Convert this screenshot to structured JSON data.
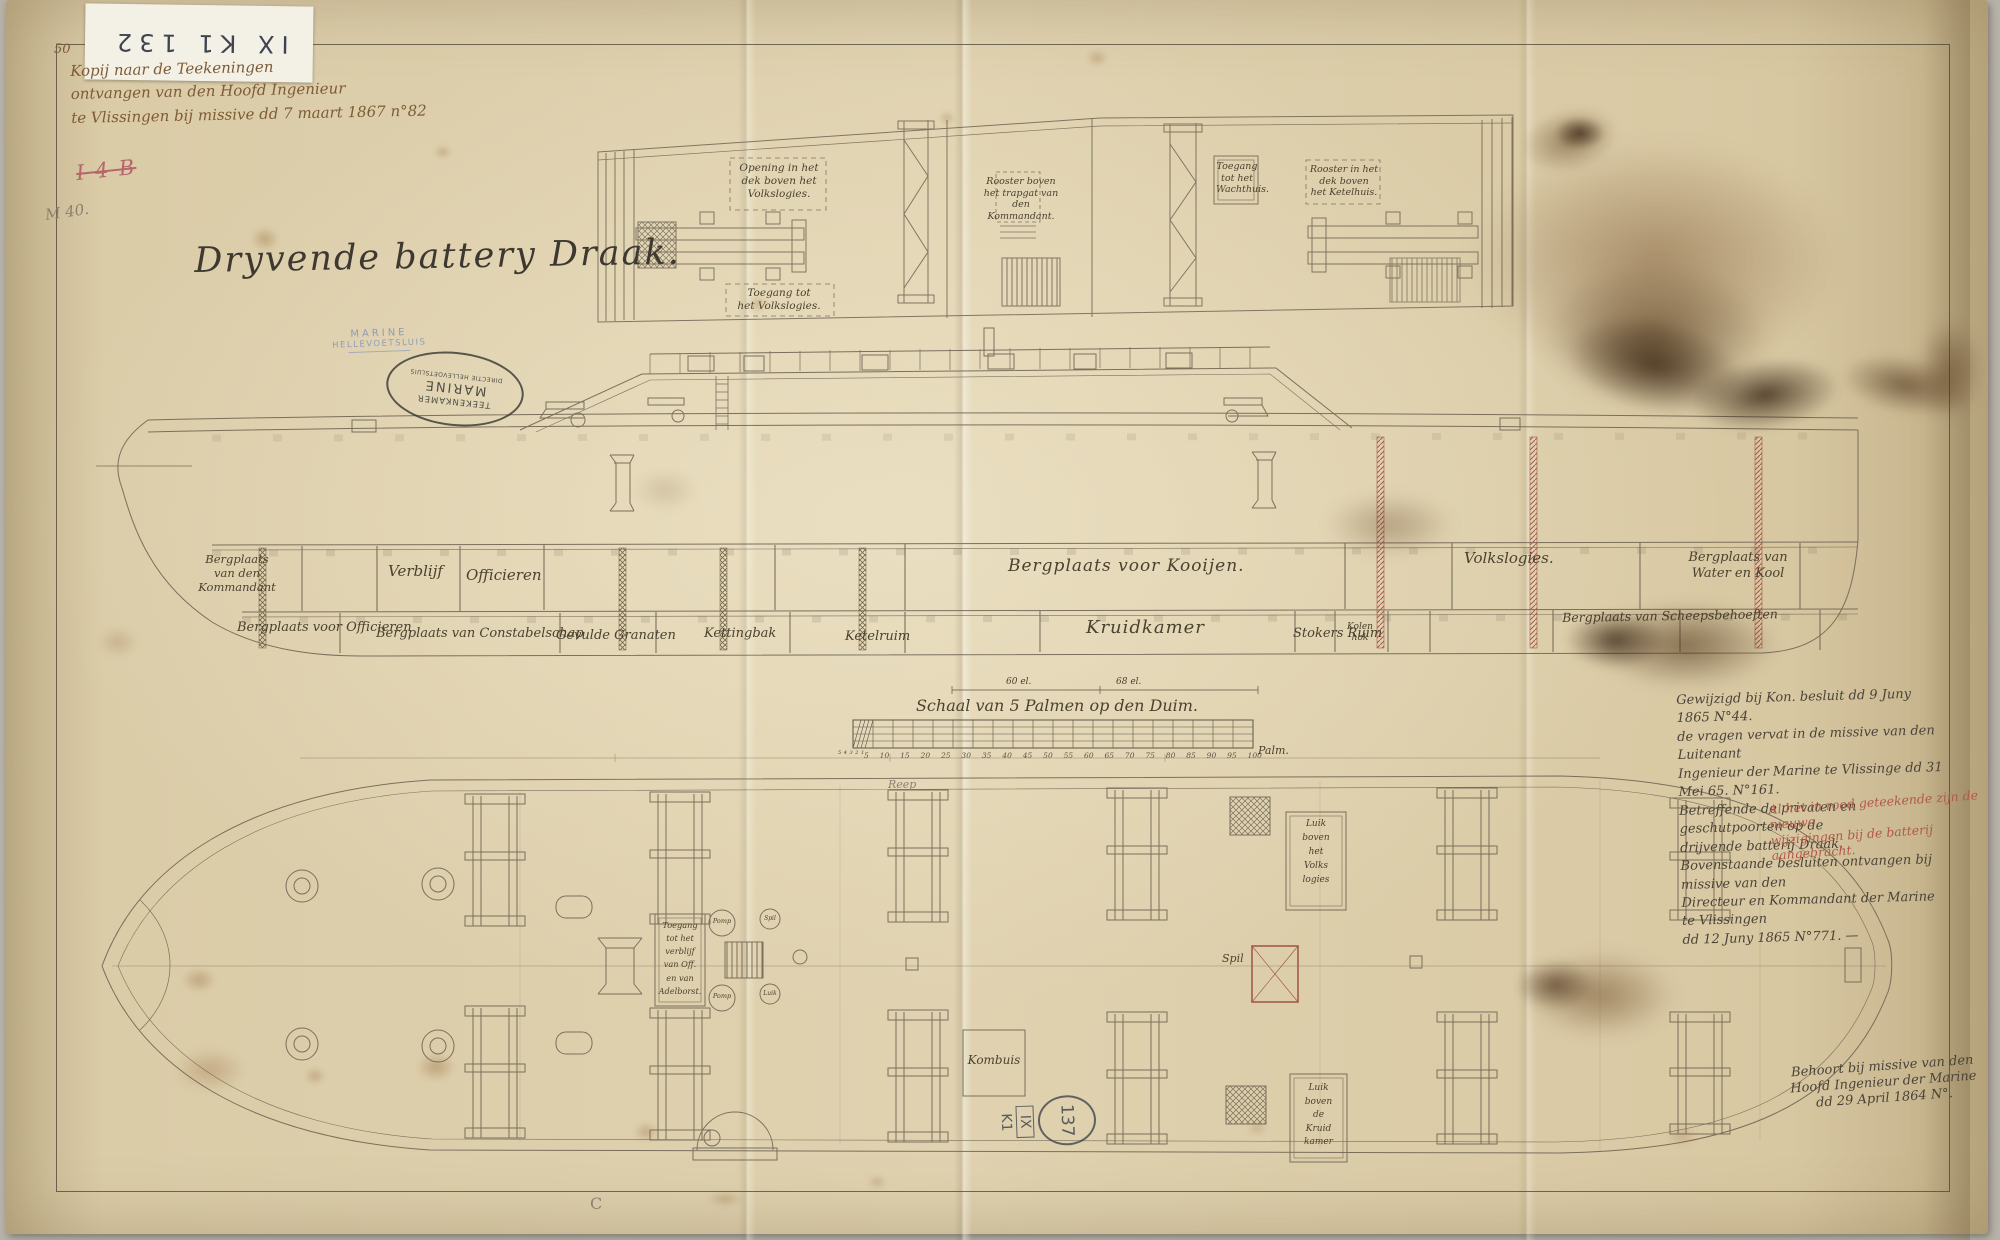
{
  "archive": {
    "corner_number": "50",
    "sticker_text": "IX K1 132",
    "red_mark": "I 4 B",
    "inventory_number": "M 40.",
    "circled_number": "137",
    "class_line1": "IX",
    "class_line2": "K1",
    "bottom_letter": "C"
  },
  "header": {
    "note": "Kopij naar de Teekeningen\nontvangen van den Hoofd Ingenieur\nte Vlissingen bij missive dd 7 maart 1867 n°82",
    "title": "Dryvende battery Draak."
  },
  "stamps": {
    "blue": {
      "line1": "MARINE",
      "line2": "HELLEVOETSLUIS"
    },
    "oval": {
      "top": "TEEKENKAMER",
      "middle": "MARINE",
      "bottom": "DIRECTIE HELLEVOETSLUIS"
    }
  },
  "top_sections": {
    "labels": [
      {
        "text": "Opening in het\ndek boven het\nVolkslogies."
      },
      {
        "text": "Toegang tot\nhet Volkslogies."
      },
      {
        "text": "Rooster boven\nhet trapgat van\nden Kommandant."
      },
      {
        "text": "Toegang\ntot het\nWachthuis."
      },
      {
        "text": "Rooster in het\ndek boven\nhet Ketelhuis."
      }
    ]
  },
  "profile": {
    "labels": [
      {
        "text": "Bergplaats\nvan den\nKommandant"
      },
      {
        "text": "Verblijf"
      },
      {
        "text": "Officieren"
      },
      {
        "text": "Bergplaats voor Officieren"
      },
      {
        "text": "Bergplaats van Constabelschap"
      },
      {
        "text": "Gevulde Granaten"
      },
      {
        "text": "Kettingbak"
      },
      {
        "text": "Ketelruim"
      },
      {
        "text": "Bergplaats voor Kooijen."
      },
      {
        "text": "Kruidkamer"
      },
      {
        "text": "Kolen\nhok"
      },
      {
        "text": "Volkslogies."
      },
      {
        "text": "Bergplaats van\nWater en Kool"
      },
      {
        "text": "Stokers Ruim"
      },
      {
        "text": "Bergplaats van Scheepsbehoeften"
      }
    ]
  },
  "scalebar": {
    "title": "Schaal van 5 Palmen op den Duim.",
    "unit": "Palm.",
    "subdivisions": "5 4 3 2 1",
    "dim_left": "60 el.",
    "dim_right": "68 el.",
    "ticks": [
      "5",
      "10",
      "15",
      "20",
      "25",
      "30",
      "35",
      "40",
      "45",
      "50",
      "55",
      "60",
      "65",
      "70",
      "75",
      "80",
      "85",
      "90",
      "95",
      "100"
    ]
  },
  "annotations": {
    "right_block": "Gewijzigd bij Kon. besluit dd 9 Juny 1865 N°44.\nde vragen vervat in de missive van den Luitenant\nIngenieur der Marine te Vlissinge dd 31 Mei 65. N°161.\nBetreffende de privaten en geschutpoorten op de\ndrijvende batterij Draak.\nBovenstaande besluiten ontvangen bij missive van den\nDirecteur en Kommandant der Marine te Vlissingen\ndd 12 Juny 1865 N°771. —",
    "right_block_red": "Al het in rood geteekende zijn de nieuwe\nwijzigingen bij de batterij aangebracht.",
    "bottom_right": "Behoort bij missive van den\nHoofd Ingenieur der Marine\ndd 29 April 1864 N°."
  },
  "deck_plan": {
    "labels": [
      {
        "text": "Reep"
      },
      {
        "text": "Luik\nboven\nhet\nVolks\nlogies"
      },
      {
        "text": "Toegang\ntot het\nverblijf\nvan Off.\nen van\nAdelborst."
      },
      {
        "text": "Kombuis"
      },
      {
        "text": "Luik\nboven\nde\nKruid\nkamer"
      },
      {
        "text": "Spil"
      },
      {
        "text": "Pomp"
      },
      {
        "text": "Pomp"
      },
      {
        "text": "Spil"
      },
      {
        "text": "Luik"
      }
    ]
  },
  "colors": {
    "paper": "#d9c9a4",
    "ink": "#6f6553",
    "blue_stamp": "#7f93bb",
    "red_ink": "#b2594b"
  }
}
